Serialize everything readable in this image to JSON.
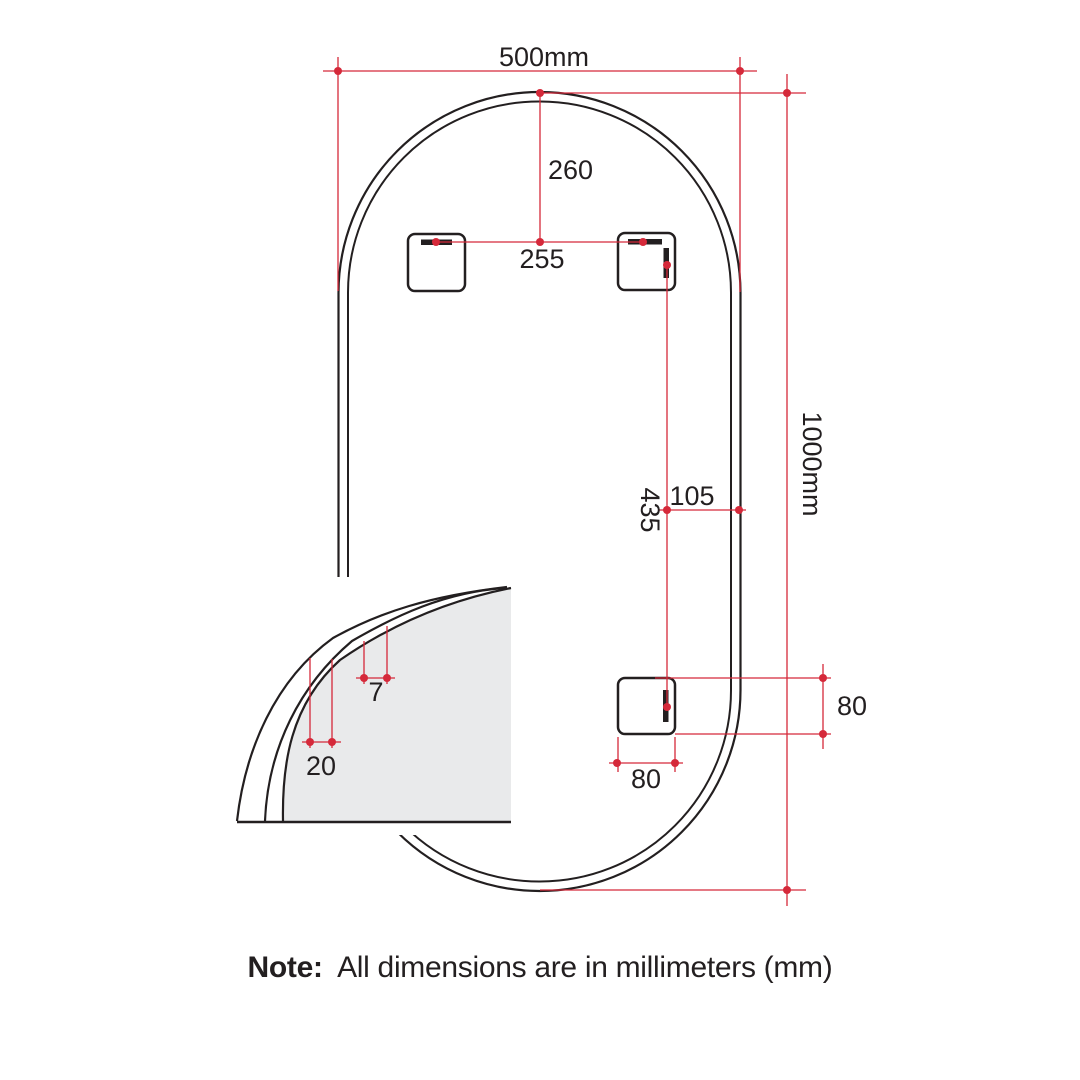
{
  "drawing": {
    "dimensions": {
      "overall_width": "500mm",
      "overall_height": "1000mm",
      "top_to_brackets": "260",
      "bracket_spacing": "255",
      "bracket_to_edge": "105",
      "upper_to_lower_bracket": "435",
      "lower_bracket_height": "80",
      "lower_bracket_width": "80",
      "detail_inner_offset": "7",
      "detail_outer_offset": "20"
    },
    "note": {
      "label": "Note:",
      "text": "All dimensions are in millimeters (mm)"
    },
    "colors": {
      "dimension_red": "#d5293a",
      "line_black": "#231f20",
      "glass_gray": "#e9eaeb",
      "background": "#ffffff"
    }
  }
}
